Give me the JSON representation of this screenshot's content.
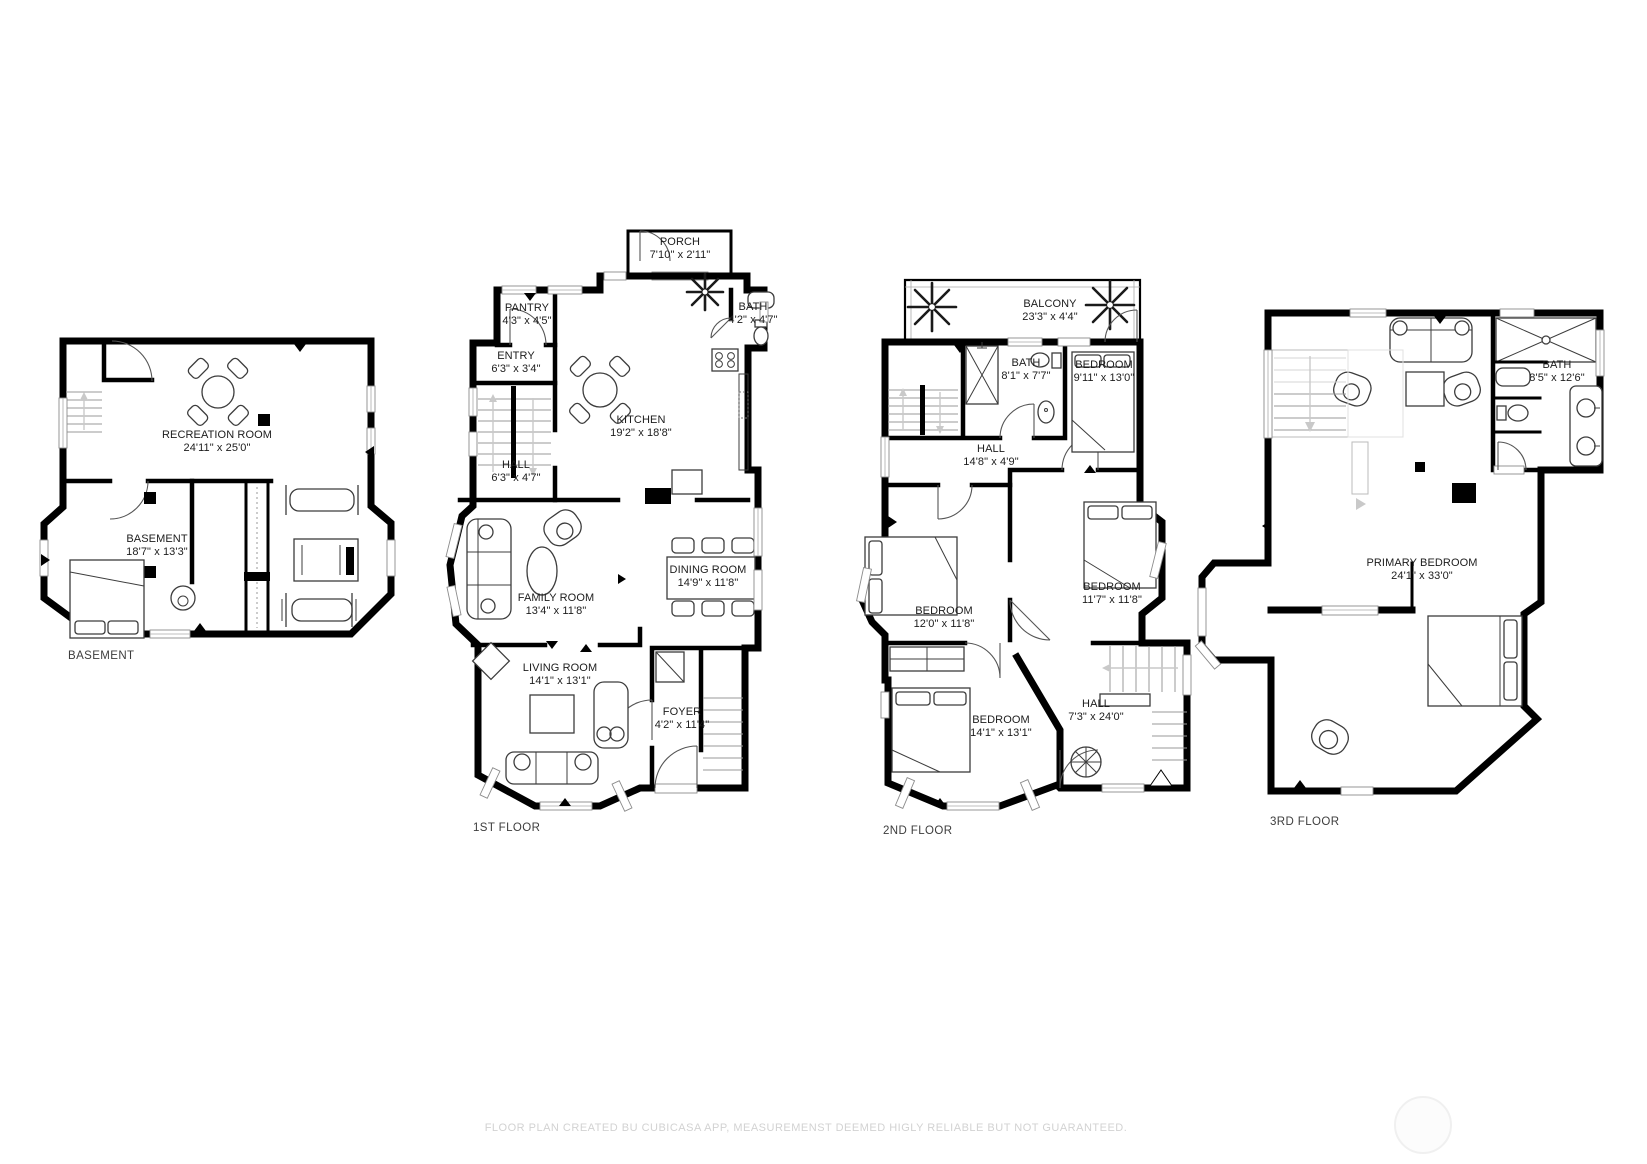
{
  "colors": {
    "wall": "#000000",
    "furniture_line": "#3c3c3c",
    "stair_line": "#9a9a9a",
    "arrow_gray": "#c9c9c9",
    "label_text": "#1c1c1c",
    "floor_title_text": "#3d3d3d",
    "footer_text": "#d2d2d2",
    "watermark_circle": "#f0f0f0",
    "background": "#ffffff"
  },
  "floors": [
    {
      "label": "BASEMENT",
      "rooms": [
        {
          "name": "RECREATION ROOM",
          "dims": "24'11\" x 25'0\""
        },
        {
          "name": "BASEMENT",
          "dims": "18'7\" x 13'3\""
        }
      ]
    },
    {
      "label": "1ST FLOOR",
      "rooms": [
        {
          "name": "PORCH",
          "dims": "7'10\" x 2'11\""
        },
        {
          "name": "PANTRY",
          "dims": "4'3\" x 4'5\""
        },
        {
          "name": "ENTRY",
          "dims": "6'3\" x 3'4\""
        },
        {
          "name": "BATH",
          "dims": "4'2\" x 4'7\""
        },
        {
          "name": "KITCHEN",
          "dims": "19'2\" x 18'8\""
        },
        {
          "name": "HALL",
          "dims": "6'3\" x 4'7\""
        },
        {
          "name": "FAMILY ROOM",
          "dims": "13'4\" x 11'8\""
        },
        {
          "name": "DINING ROOM",
          "dims": "14'9\" x 11'8\""
        },
        {
          "name": "LIVING ROOM",
          "dims": "14'1\" x 13'1\""
        },
        {
          "name": "FOYER",
          "dims": "4'2\" x 11'4\""
        }
      ]
    },
    {
      "label": "2ND FLOOR",
      "rooms": [
        {
          "name": "BALCONY",
          "dims": "23'3\" x 4'4\""
        },
        {
          "name": "BATH",
          "dims": "8'1\" x 7'7\""
        },
        {
          "name": "BEDROOM",
          "dims": "9'11\" x 13'0\""
        },
        {
          "name": "HALL",
          "dims": "14'8\" x 4'9\""
        },
        {
          "name": "BEDROOM",
          "dims": "12'0\" x 11'8\""
        },
        {
          "name": "BEDROOM",
          "dims": "11'7\" x 11'8\""
        },
        {
          "name": "BEDROOM",
          "dims": "14'1\" x 13'1\""
        },
        {
          "name": "HALL",
          "dims": "7'3\" x 24'0\""
        }
      ]
    },
    {
      "label": "3RD FLOOR",
      "rooms": [
        {
          "name": "BATH",
          "dims": "8'5\" x 12'6\""
        },
        {
          "name": "PRIMARY BEDROOM",
          "dims": "24'1\" x 33'0\""
        }
      ]
    }
  ],
  "footer": {
    "disclaimer": "FLOOR PLAN CREATED BU CUBICASA APP, MEASUREMENST DEEMED HIGLY RELIABLE BUT NOT GUARANTEED."
  }
}
